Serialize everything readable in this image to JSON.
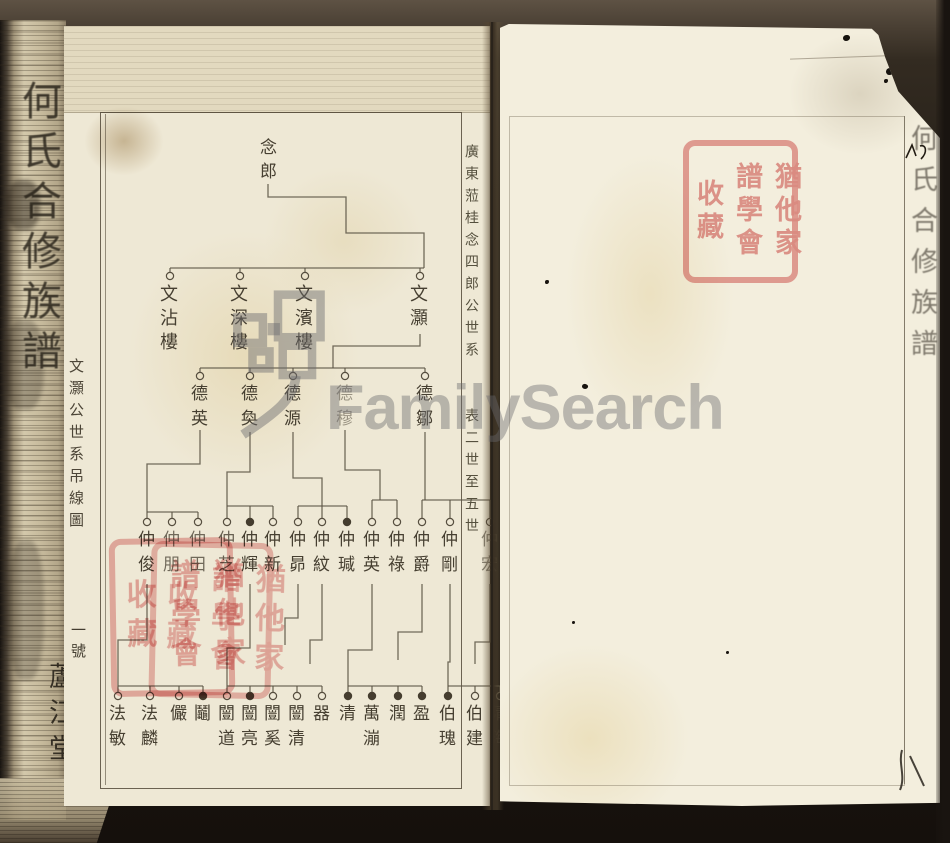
{
  "book": {
    "spine_title": "何氏合修族譜",
    "spine_hall_label": "蘆江堂",
    "left_margin_caption": "文灝公世系吊線圖",
    "left_margin_number": "一號",
    "right_margin_caption_top": "廣東蒞桂念四郎公世系",
    "right_margin_caption_bottom": "表二世至五世",
    "right_page_edge_title": "何氏合修族譜"
  },
  "watermark": {
    "text": "FamilySearch"
  },
  "seal": {
    "columns": [
      "猶他家",
      "譜學會",
      "收藏"
    ]
  },
  "colors": {
    "paper_left": "#eee8d5",
    "paper_right": "#f3eedd",
    "ink": "#463f31",
    "tree_line": "#5b5344",
    "seal_red": "#e28888",
    "watermark_gray": "#6a6a6e"
  },
  "tree": {
    "root": {
      "name": "念郎",
      "x": 268,
      "y": 138
    },
    "generations": [
      {
        "circle_y": 276,
        "name_y": 284,
        "cls": "g2",
        "nodes": [
          {
            "x": 170,
            "name": "文沾樓"
          },
          {
            "x": 240,
            "name": "文深樓"
          },
          {
            "x": 305,
            "name": "文濱樓"
          },
          {
            "x": 420,
            "name": "文灝"
          }
        ]
      },
      {
        "circle_y": 376,
        "name_y": 384,
        "cls": "",
        "nodes": [
          {
            "x": 200,
            "name": "德英"
          },
          {
            "x": 250,
            "name": "德奐"
          },
          {
            "x": 293,
            "name": "德源"
          },
          {
            "x": 345,
            "name": "德穆",
            "opacity": 0.5
          },
          {
            "x": 425,
            "name": "德鄒"
          }
        ]
      },
      {
        "circle_y": 522,
        "name_y": 530,
        "cls": "",
        "nodes": [
          {
            "x": 147,
            "name": "仲俊"
          },
          {
            "x": 172,
            "name": "仲朋",
            "opacity": 0.75
          },
          {
            "x": 198,
            "name": "仲田",
            "opacity": 0.75
          },
          {
            "x": 227,
            "name": "仲芝",
            "opacity": 0.8
          },
          {
            "x": 250,
            "name": "仲輝",
            "filled": true
          },
          {
            "x": 273,
            "name": "仲新"
          },
          {
            "x": 298,
            "name": "仲昴"
          },
          {
            "x": 322,
            "name": "仲紋"
          },
          {
            "x": 347,
            "name": "仲瑊",
            "filled": true
          },
          {
            "x": 372,
            "name": "仲英"
          },
          {
            "x": 397,
            "name": "仲祿"
          },
          {
            "x": 422,
            "name": "仲爵"
          },
          {
            "x": 450,
            "name": "仲剛"
          },
          {
            "x": 490,
            "name": "仲宏",
            "opacity": 0.6
          }
        ]
      },
      {
        "circle_y": 696,
        "name_y": 704,
        "cls": "",
        "nodes": [
          {
            "x": 118,
            "name": "法敏"
          },
          {
            "x": 150,
            "name": "法麟"
          },
          {
            "x": 179,
            "name": "儼"
          },
          {
            "x": 203,
            "name": "鬮",
            "filled": true
          },
          {
            "x": 227,
            "name": "闓道"
          },
          {
            "x": 250,
            "name": "闓亮",
            "filled": true
          },
          {
            "x": 273,
            "name": "闓奚"
          },
          {
            "x": 297,
            "name": "闓清"
          },
          {
            "x": 322,
            "name": "器"
          },
          {
            "x": 348,
            "name": "清",
            "filled": true
          },
          {
            "x": 372,
            "name": "萬漰",
            "filled": true
          },
          {
            "x": 398,
            "name": "潤",
            "filled": true
          },
          {
            "x": 422,
            "name": "盈",
            "filled": true
          },
          {
            "x": 448,
            "name": "伯瑰",
            "filled": true
          },
          {
            "x": 475,
            "name": "伯建"
          },
          {
            "x": 500,
            "name": "清海",
            "opacity": 0.35
          }
        ]
      }
    ],
    "lines": [
      [
        268,
        184,
        268,
        197,
        346,
        197,
        346,
        233,
        424,
        233,
        424,
        268
      ],
      [
        170,
        268,
        424,
        268
      ],
      [
        170,
        268,
        170,
        272
      ],
      [
        240,
        268,
        240,
        272
      ],
      [
        305,
        268,
        305,
        272
      ],
      [
        420,
        268,
        420,
        272
      ],
      [
        420,
        334,
        420,
        346,
        333,
        346,
        333,
        368
      ],
      [
        200,
        368,
        425,
        368
      ],
      [
        200,
        368,
        200,
        372
      ],
      [
        250,
        368,
        250,
        372
      ],
      [
        293,
        368,
        293,
        372
      ],
      [
        345,
        368,
        345,
        372
      ],
      [
        425,
        368,
        425,
        372
      ],
      [
        200,
        430,
        200,
        464,
        147,
        464,
        147,
        512
      ],
      [
        147,
        512,
        198,
        512
      ],
      [
        147,
        512,
        147,
        518
      ],
      [
        172,
        512,
        172,
        518
      ],
      [
        198,
        512,
        198,
        518
      ],
      [
        250,
        432,
        250,
        472,
        227,
        472,
        227,
        506
      ],
      [
        227,
        506,
        273,
        506
      ],
      [
        227,
        506,
        227,
        518
      ],
      [
        250,
        506,
        250,
        518
      ],
      [
        273,
        506,
        273,
        518
      ],
      [
        293,
        432,
        293,
        478,
        322,
        478,
        322,
        506
      ],
      [
        298,
        506,
        347,
        506
      ],
      [
        298,
        506,
        298,
        518
      ],
      [
        322,
        506,
        322,
        518
      ],
      [
        347,
        506,
        347,
        518
      ],
      [
        345,
        430,
        345,
        470,
        380,
        470,
        380,
        500
      ],
      [
        372,
        500,
        397,
        500
      ],
      [
        372,
        500,
        372,
        518
      ],
      [
        397,
        500,
        397,
        518
      ],
      [
        425,
        432,
        425,
        500
      ],
      [
        422,
        500,
        490,
        500
      ],
      [
        422,
        500,
        422,
        518
      ],
      [
        450,
        500,
        450,
        518
      ],
      [
        490,
        500,
        490,
        518
      ],
      [
        147,
        584,
        147,
        640,
        118,
        640,
        118,
        686
      ],
      [
        118,
        686,
        203,
        686
      ],
      [
        118,
        686,
        118,
        692
      ],
      [
        150,
        686,
        150,
        692
      ],
      [
        179,
        686,
        179,
        692
      ],
      [
        203,
        686,
        203,
        692
      ],
      [
        250,
        584,
        250,
        648,
        227,
        648,
        227,
        686
      ],
      [
        227,
        686,
        322,
        686
      ],
      [
        227,
        686,
        227,
        692
      ],
      [
        250,
        686,
        250,
        692
      ],
      [
        273,
        686,
        273,
        692
      ],
      [
        297,
        686,
        297,
        692
      ],
      [
        322,
        686,
        322,
        692
      ],
      [
        372,
        584,
        372,
        650,
        348,
        650,
        348,
        686
      ],
      [
        348,
        686,
        422,
        686
      ],
      [
        348,
        686,
        348,
        692
      ],
      [
        372,
        686,
        372,
        692
      ],
      [
        398,
        686,
        398,
        692
      ],
      [
        422,
        686,
        422,
        692
      ],
      [
        450,
        584,
        450,
        662,
        448,
        662,
        448,
        686
      ],
      [
        448,
        686,
        500,
        686
      ],
      [
        448,
        686,
        448,
        692
      ],
      [
        475,
        686,
        475,
        692
      ],
      [
        500,
        686,
        500,
        692
      ],
      [
        422,
        584,
        422,
        632,
        398,
        632,
        398,
        660
      ],
      [
        490,
        584,
        490,
        642,
        475,
        642,
        475,
        664
      ],
      [
        322,
        584,
        322,
        640,
        310,
        640,
        310,
        664
      ],
      [
        298,
        584,
        298,
        618,
        285,
        618,
        285,
        645
      ]
    ]
  }
}
